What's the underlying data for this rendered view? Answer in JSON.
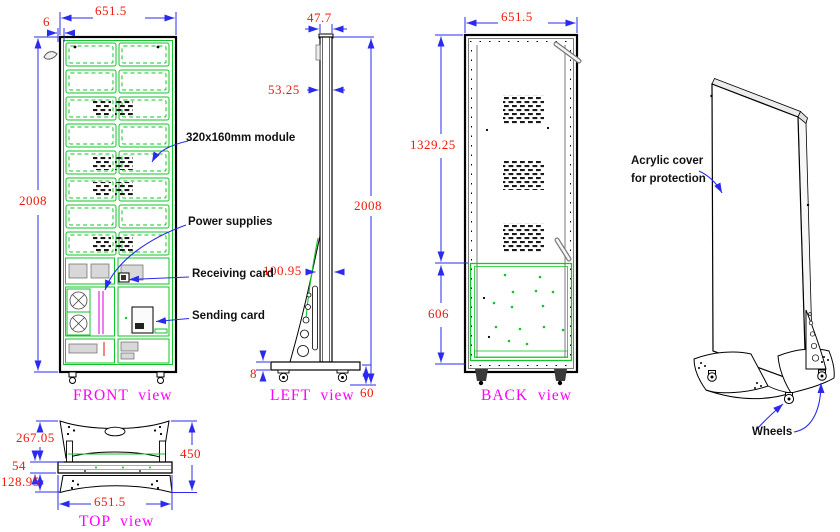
{
  "colors": {
    "dimension_text": "#f0180c",
    "dimension_lines": "#2b2bf0",
    "module_green": "#13c42a",
    "view_title_magenta": "#ff00ff",
    "outline_black": "#000000"
  },
  "views": {
    "front": {
      "title": "FRONT  view",
      "dims": {
        "width": "651.5",
        "bezel": "6",
        "height": "2008"
      }
    },
    "left": {
      "title": "LEFT  view",
      "dims": {
        "panel_thickness": "47.7",
        "cabinet_depth": "53.25",
        "height": "2008",
        "bracket_depth": "100.95",
        "base_plate_thickness": "8",
        "wheel_height": "60"
      }
    },
    "back": {
      "title": "BACK  view",
      "dims": {
        "width": "651.5",
        "upper_section_height": "1329.25",
        "lower_door_height": "606"
      }
    },
    "top": {
      "title": "TOP  view",
      "dims": {
        "front_foot_depth": "267.05",
        "cabinet_depth": "54",
        "rear_foot_depth": "128.95",
        "total_base_depth": "450",
        "width": "651.5"
      }
    },
    "perspective": {
      "labels": {
        "acrylic_line1": "Acrylic cover",
        "acrylic_line2": "for protection",
        "wheels": "Wheels"
      }
    }
  },
  "annotations": {
    "module": "320x160mm module",
    "power_supplies": "Power supplies",
    "receiving_card": "Receiving card",
    "sending_card": "Sending card"
  }
}
